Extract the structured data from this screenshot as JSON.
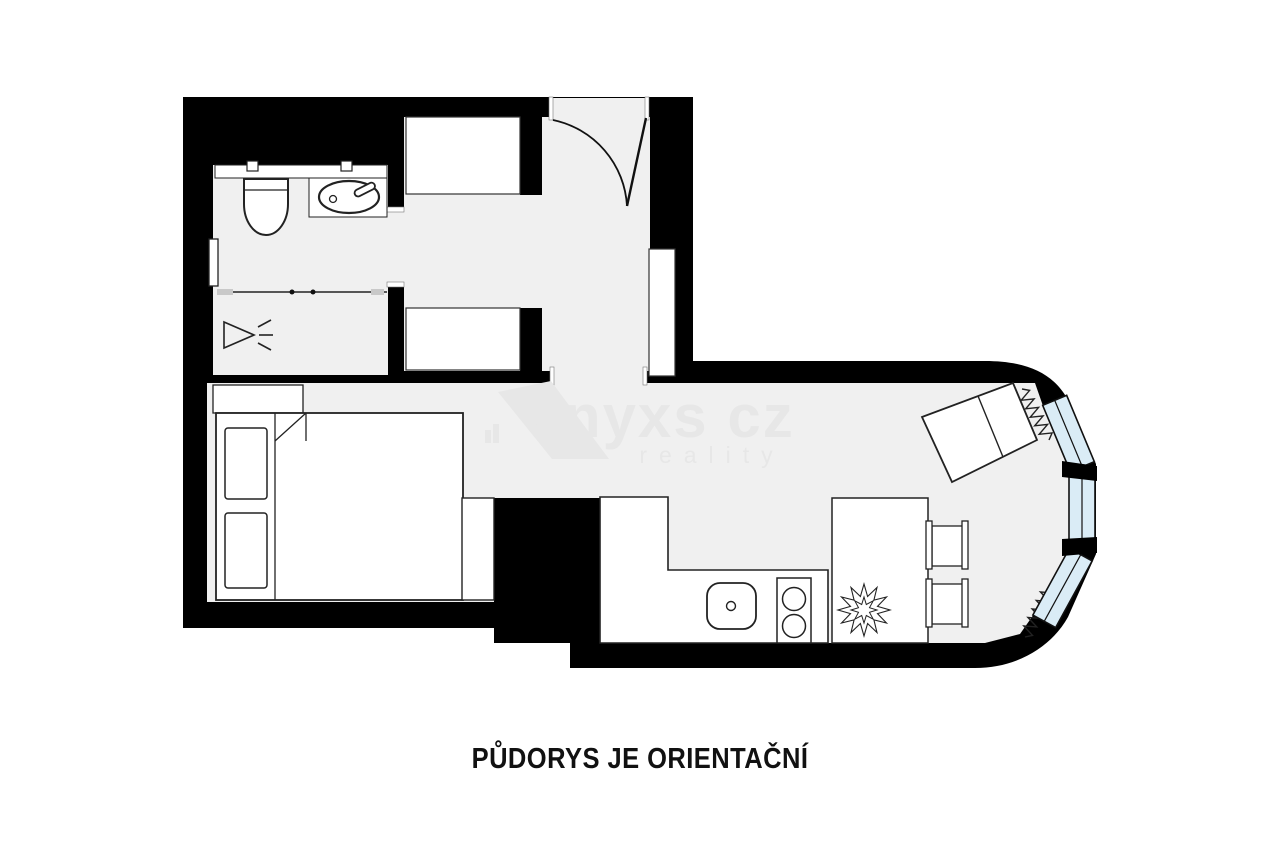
{
  "caption": {
    "text": "PŮDORYS JE ORIENTAČNÍ"
  },
  "watermark": {
    "brand": "onyxs cz",
    "sub": "reality"
  },
  "colors": {
    "page": "#ffffff",
    "wall": "#000000",
    "floor": "#f0f0f0",
    "furniture": "#ffffff",
    "window": "#daecf6",
    "outline": "#1a1a1a",
    "watermark": "#e7e7e7",
    "caption": "#111111"
  },
  "rooms": [
    {
      "name": "bathroom"
    },
    {
      "name": "entry-hall"
    },
    {
      "name": "living-room-with-kitchenette"
    }
  ],
  "fixtures": [
    "toilet",
    "bathroom-sink",
    "vanity-counter",
    "towel-radiator",
    "shower",
    "shower-screen",
    "wardrobe-top",
    "wardrobe-bottom",
    "entry-door",
    "wall-niche",
    "double-bed",
    "pillow-left",
    "pillow-right",
    "dresser",
    "side-table",
    "desk",
    "kitchen-counter",
    "kitchen-sink",
    "cooktop",
    "dining-table",
    "plant",
    "chair-top",
    "chair-bottom",
    "radiator-top",
    "radiator-bottom",
    "window-1",
    "window-2",
    "window-3"
  ]
}
